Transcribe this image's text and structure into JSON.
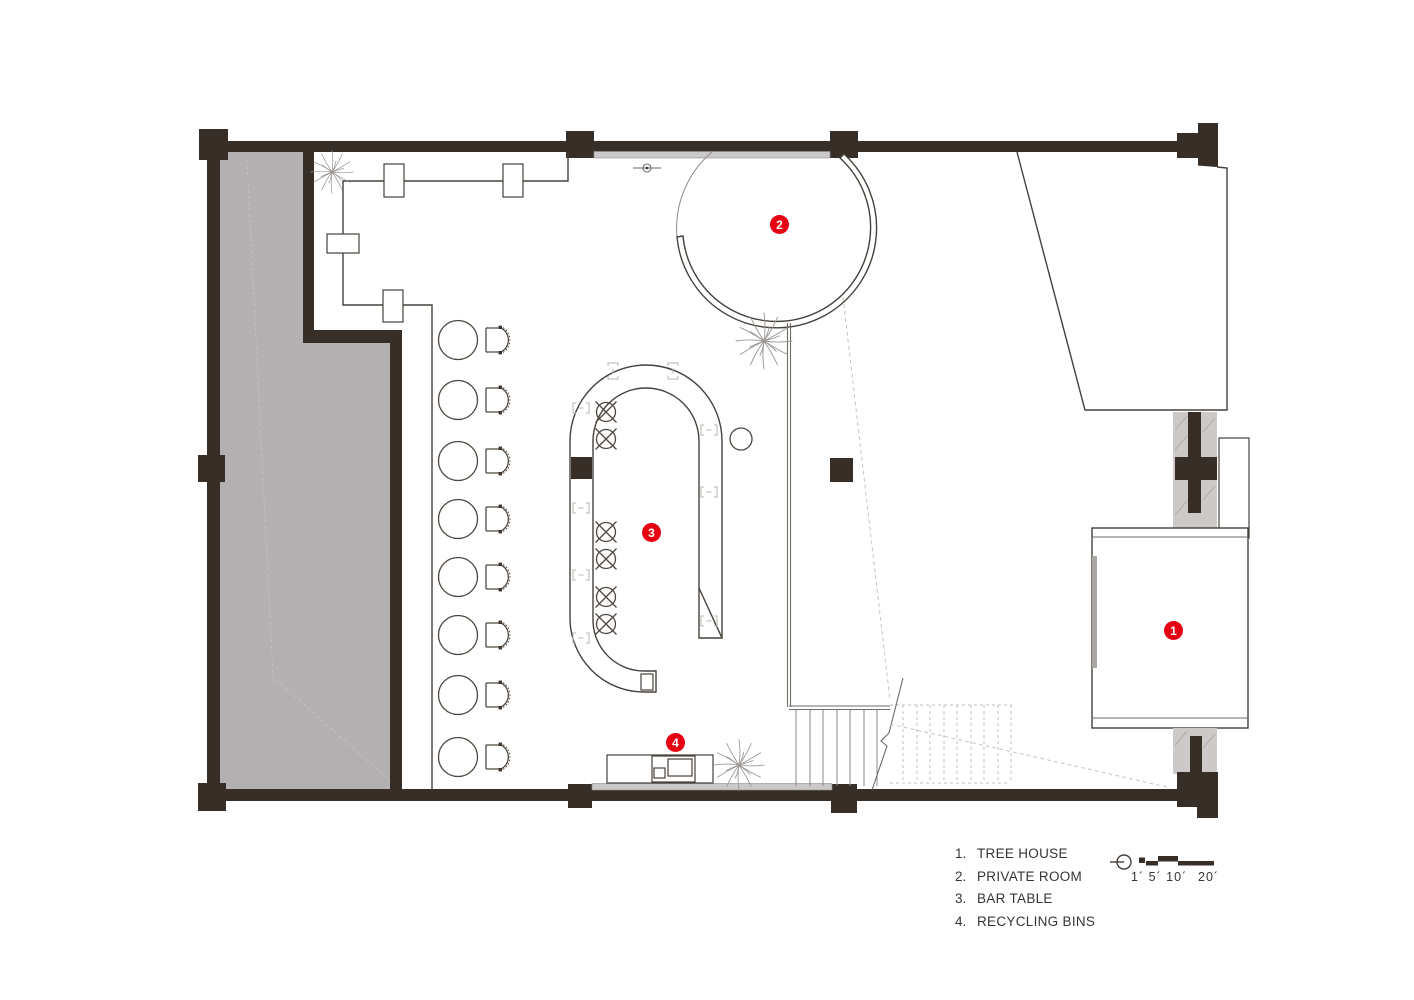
{
  "legend": {
    "items": [
      {
        "num": "1.",
        "label": "TREE HOUSE"
      },
      {
        "num": "2.",
        "label": "PRIVATE ROOM"
      },
      {
        "num": "3.",
        "label": "BAR TABLE"
      },
      {
        "num": "4.",
        "label": "RECYCLING BINS"
      }
    ]
  },
  "markers": {
    "tree_house": "1",
    "private_room": "2",
    "bar_table": "3",
    "recycling_bins": "4"
  },
  "scale": {
    "small_ticks": "1´ 5´ 10´",
    "large_tick": "20´"
  },
  "plan_stats": {
    "dining_table_count": 8,
    "bar_stool_count": 6,
    "plant_count": 3
  },
  "colors": {
    "wall": "#382e28",
    "line": "#46403a",
    "terrace": "#b2b0b0",
    "accent_red": "#e60012"
  }
}
